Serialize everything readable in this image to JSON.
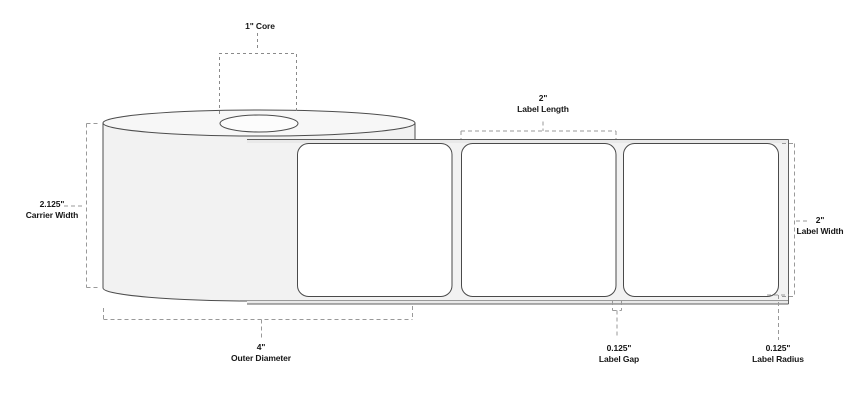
{
  "diagram": {
    "subject": "label roll dimension diagram",
    "visible_label_count": 3,
    "callouts": {
      "core": {
        "text": "1\" Core"
      },
      "label_length": {
        "value": "2\"",
        "label": "Label Length"
      },
      "carrier_width": {
        "value": "2.125\"",
        "label": "Carrier Width"
      },
      "label_width": {
        "value": "2\"",
        "label": "Label Width"
      },
      "outer_diameter": {
        "value": "4\"",
        "label": "Outer Diameter"
      },
      "label_gap": {
        "value": "0.125\"",
        "label": "Label Gap"
      },
      "label_radius": {
        "value": "0.125\"",
        "label": "Label Radius"
      }
    }
  },
  "colors": {
    "background": "#ffffff",
    "outline": "#4d4d4d",
    "label_border": "#4a4a4a",
    "dashed_line": "#999999",
    "dashed_line_dark": "#8a8a8a",
    "roll_face": "#f7f7f7",
    "roll_body": "#f2f2f2",
    "core_hole": "#fcfcfc",
    "liner": "#f2f2f2",
    "liner_edge_band": "#e9e9e9",
    "liner_edge_line": "#5f5f5f",
    "label_fill": "#ffffff",
    "text": "#161616"
  }
}
